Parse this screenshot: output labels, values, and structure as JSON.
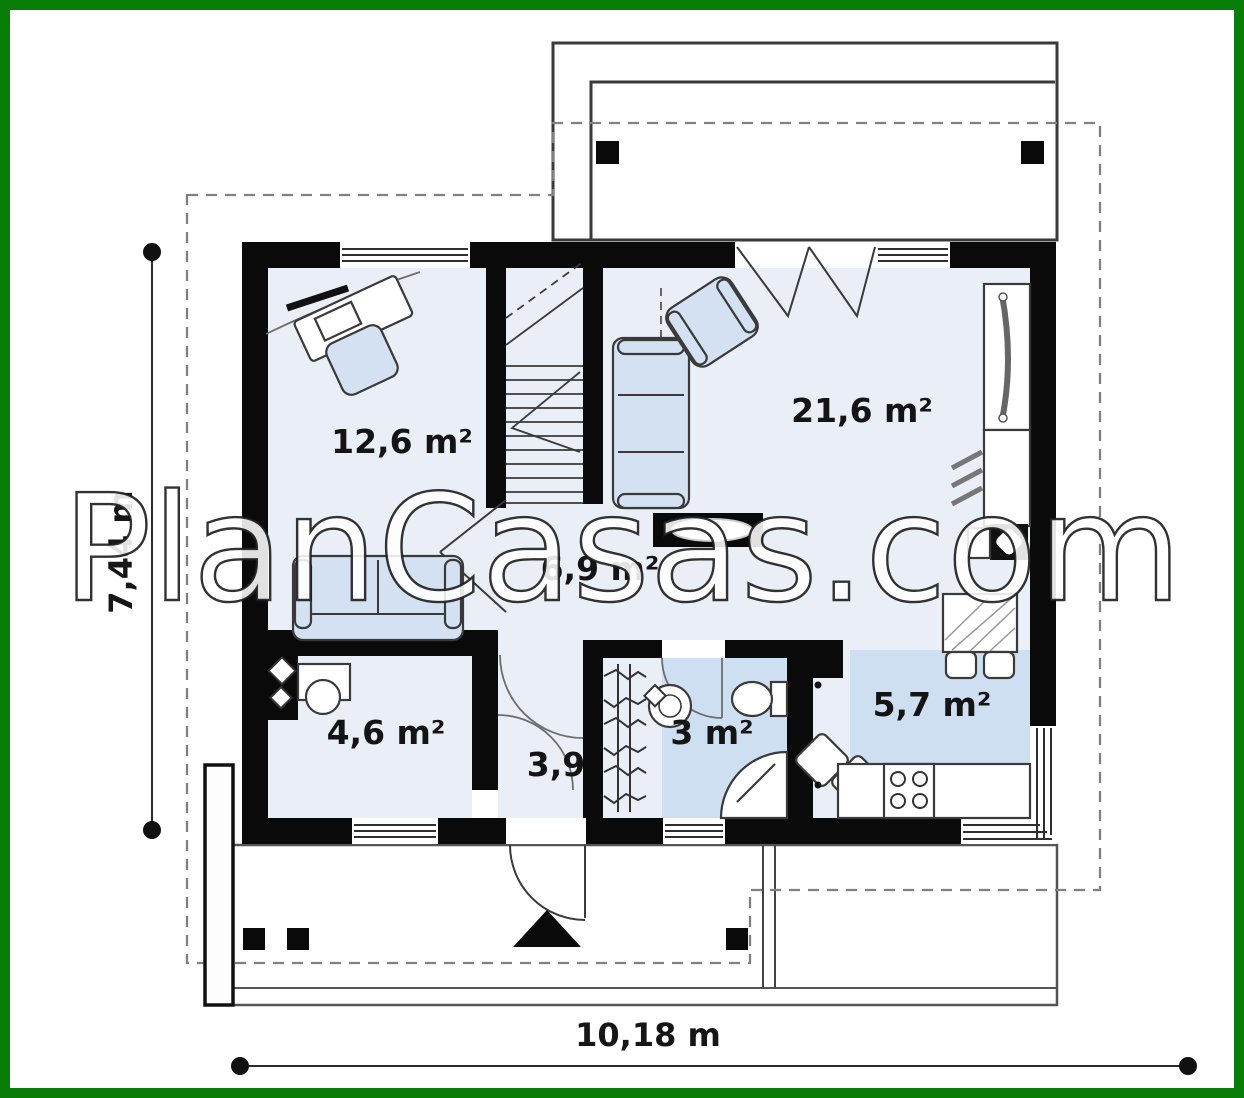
{
  "watermark": {
    "text": "PlanCasas.com"
  },
  "plan": {
    "rooms": [
      {
        "name": "bedroom",
        "area": "12,6 m²"
      },
      {
        "name": "living-room",
        "area": "21,6 m²"
      },
      {
        "name": "hall",
        "area": "6,9 m²"
      },
      {
        "name": "utility-room",
        "area": "4,6 m²"
      },
      {
        "name": "entry-hall",
        "area": "3,9"
      },
      {
        "name": "bathroom",
        "area": "3 m²"
      },
      {
        "name": "kitchen",
        "area": "5,7 m²"
      }
    ],
    "dimensions": {
      "overall_depth": "7,44 m",
      "overall_width": "10,18 m"
    }
  },
  "colors": {
    "frame_green": "#087d08",
    "wall_black": "#0a0a0a",
    "floor_light": "#eaeef7",
    "floor_wet": "#cfdff2",
    "furniture_fill": "#d3e1f2",
    "dimension_text": "#161616"
  }
}
